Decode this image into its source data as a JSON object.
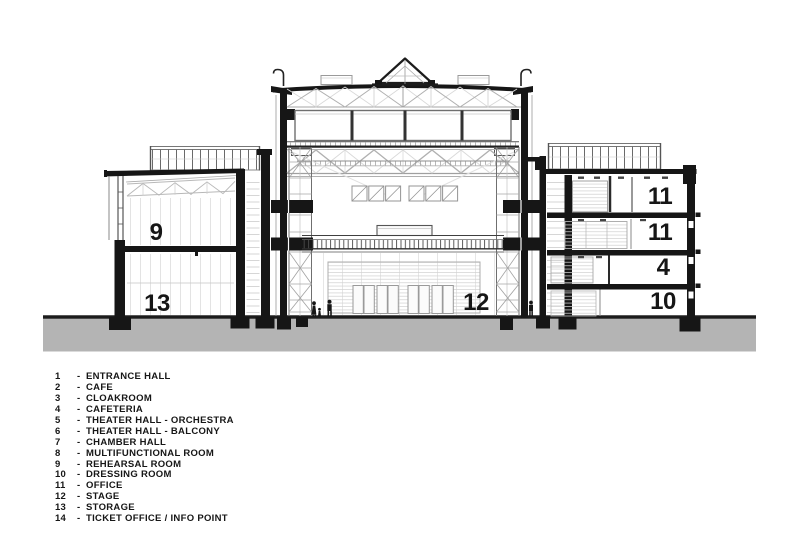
{
  "drawing": {
    "room_labels": [
      {
        "id": "room-9",
        "text": "9"
      },
      {
        "id": "room-13",
        "text": "13"
      },
      {
        "id": "room-12",
        "text": "12"
      },
      {
        "id": "room-11-upper",
        "text": "11"
      },
      {
        "id": "room-11-lower",
        "text": "11"
      },
      {
        "id": "room-4",
        "text": "4"
      },
      {
        "id": "room-10",
        "text": "10"
      }
    ]
  },
  "legend": {
    "separator": "-",
    "items": [
      {
        "num": "1",
        "name": "ENTRANCE HALL"
      },
      {
        "num": "2",
        "name": "CAFE"
      },
      {
        "num": "3",
        "name": "CLOAKROOM"
      },
      {
        "num": "4",
        "name": "CAFETERIA"
      },
      {
        "num": "5",
        "name": "THEATER HALL - ORCHESTRA"
      },
      {
        "num": "6",
        "name": "THEATER HALL - BALCONY"
      },
      {
        "num": "7",
        "name": "CHAMBER HALL"
      },
      {
        "num": "8",
        "name": "MULTIFUNCTIONAL ROOM"
      },
      {
        "num": "9",
        "name": "REHEARSAL ROOM"
      },
      {
        "num": "10",
        "name": "DRESSING ROOM"
      },
      {
        "num": "11",
        "name": "OFFICE"
      },
      {
        "num": "12",
        "name": "STAGE"
      },
      {
        "num": "13",
        "name": "STORAGE"
      },
      {
        "num": "14",
        "name": "TICKET OFFICE / INFO POINT"
      }
    ]
  },
  "colors": {
    "ink": "#161616",
    "ground": "#b4b4b4",
    "truss": "#b0b0b0"
  }
}
